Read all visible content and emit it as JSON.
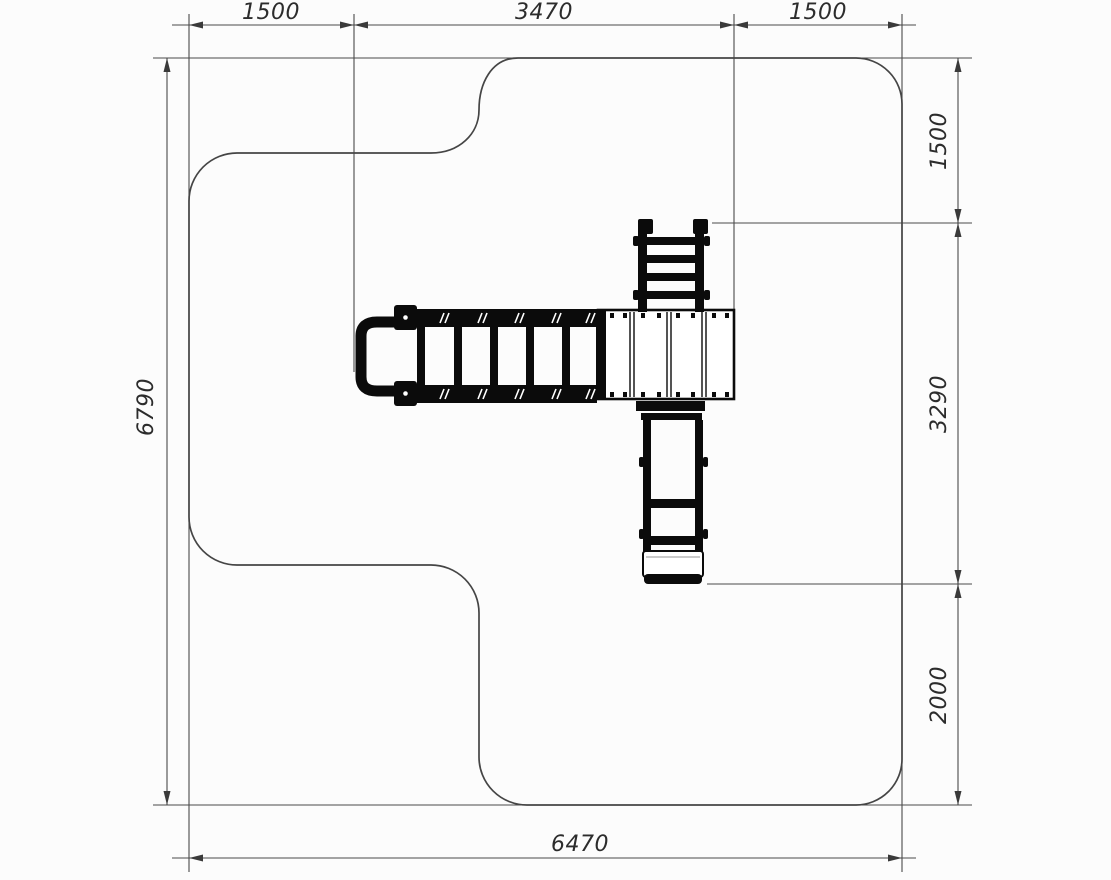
{
  "dimensions": {
    "top_left": "1500",
    "top_middle": "3470",
    "top_right": "1500",
    "left_side": "6790",
    "right_top": "1500",
    "right_middle": "3290",
    "right_bottom": "2000",
    "bottom": "6470"
  },
  "colors": {
    "background": "#fcfcfc",
    "line": "#4a4a4a",
    "equipment": "#0b0b0b",
    "text": "#2c2c2c"
  }
}
